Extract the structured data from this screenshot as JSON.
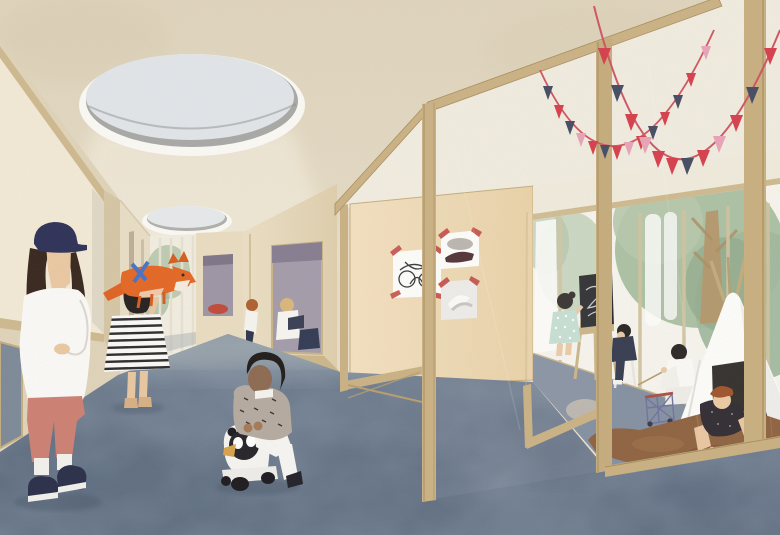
{
  "meta": {
    "kind": "architectural interior rendering",
    "style": "flat collage / watercolor",
    "width": 780,
    "height": 535
  },
  "scene": {
    "description": "Collage-style architectural rendering of a kindergarten interior: a long corridor with mottled blue carpet and oval ceiling skylights; a teacher in a navy cap stands at left; a girl in a striped dress holds up an orange fox toy; a toddler rides a panda ride-on toy; reading nooks with children are carved into the corridor wall; beyond a wooden-framed glass partition hung with red, navy and pink bunting, children play in a room with a chalkboard easel, a wire cart, a white teepee on a brown hide rug, and trees visible through a glazed wall.",
    "areas": [
      "ceiling with oval skylights",
      "left wall with mirror opening",
      "corridor with blue carpet",
      "reading nooks",
      "wooden partition wall with children's drawings",
      "glass partition with open doors",
      "playroom with teepee",
      "glazed wall with trees outside"
    ],
    "people": [
      {
        "id": "teacher",
        "details": "woman, navy cap, dark hair, white shirt, salmon cropped trousers, navy slip-on shoes"
      },
      {
        "id": "striped-dress-girl",
        "details": "girl in black-and-white striped dress lifting an orange fox toy"
      },
      {
        "id": "ride-on-child",
        "details": "toddler in speckled grey cardigan and white trousers on a panda ride-on toy"
      },
      {
        "id": "nook-reader-blonde",
        "details": "blonde child reading in large wall nook"
      },
      {
        "id": "nook-reader-ginger",
        "details": "ginger-haired child seated at far nook"
      },
      {
        "id": "mint-dress-girl",
        "details": "girl in mint polka-dot dress drawing at chalkboard"
      },
      {
        "id": "navy-boy",
        "details": "boy in navy clothes seated on a small chair"
      },
      {
        "id": "white-reader",
        "details": "child in white reading beside the teepee"
      },
      {
        "id": "crawling-child",
        "details": "auburn-haired child in dark speckled top crawling out of the teepee"
      }
    ],
    "props": [
      "orange fox toy",
      "panda ride-on toy",
      "red cushion",
      "navy cushion",
      "chalkboard easel",
      "wire cart toy",
      "white teepee tent",
      "brown hide rug",
      "grey poufs",
      "two bunting garlands",
      "three pinned children's drawings"
    ]
  },
  "palette": {
    "wallBeige": "#e6dcc8",
    "wallBeigeDark": "#ddd1b8",
    "ceilingRoom": "#f2ede0",
    "woodFrame": "#cbb286",
    "woodFrameDark": "#a98f5f",
    "woodWall": "#f0dcba",
    "carpet": "#6d7b8e",
    "carpetDark": "#57667a",
    "carpetLight": "#93a0ae",
    "roomCarpet": "#7f8c9e",
    "skylightGlass": "#e2e6ea",
    "skylightRim": "#a9a9a7",
    "treeGreen": "#a9bfa1",
    "treeGreenDark": "#8aa486",
    "trunk": "#b29266",
    "teepee": "#fdfdfb",
    "teepeeDoor": "#2b2724",
    "rug": "#8a5c38",
    "rugDark": "#744628",
    "flagRed": "#d6404d",
    "flagNavy": "#454c63",
    "flagPink": "#e8a4b8",
    "string": "#cf5563",
    "skin": "#e9c8a2",
    "skinDark": "#8d6b52",
    "hairBlack": "#241f1d",
    "hairBrown": "#38271e",
    "hairGinger": "#b06030",
    "hairAuburn": "#9a4c22",
    "hairBlonde": "#d9b87c",
    "capNavy": "#2e3258",
    "pantsSalmon": "#cd8173",
    "shoeNavy": "#2a2f4a",
    "cardigan": "#b5aba1",
    "mintDress": "#c3ded1",
    "navyCloth": "#2d3348",
    "nookPurple": "#a49cab",
    "cushionRed": "#c14b3c",
    "cushionNavy": "#333b55",
    "chalkboard": "#202024",
    "pouf": "#b7b2a9",
    "fox": "#e56825",
    "ribbonBlue": "#4a72c4"
  },
  "bunting": {
    "garland_a_colors": "navy,red,navy,pink,red,navy,red,pink,red,navy,red,navy,red,pink",
    "garland_b_colors": "red,navy,red,pink,red,red,navy,red,pink,red,navy,red"
  }
}
